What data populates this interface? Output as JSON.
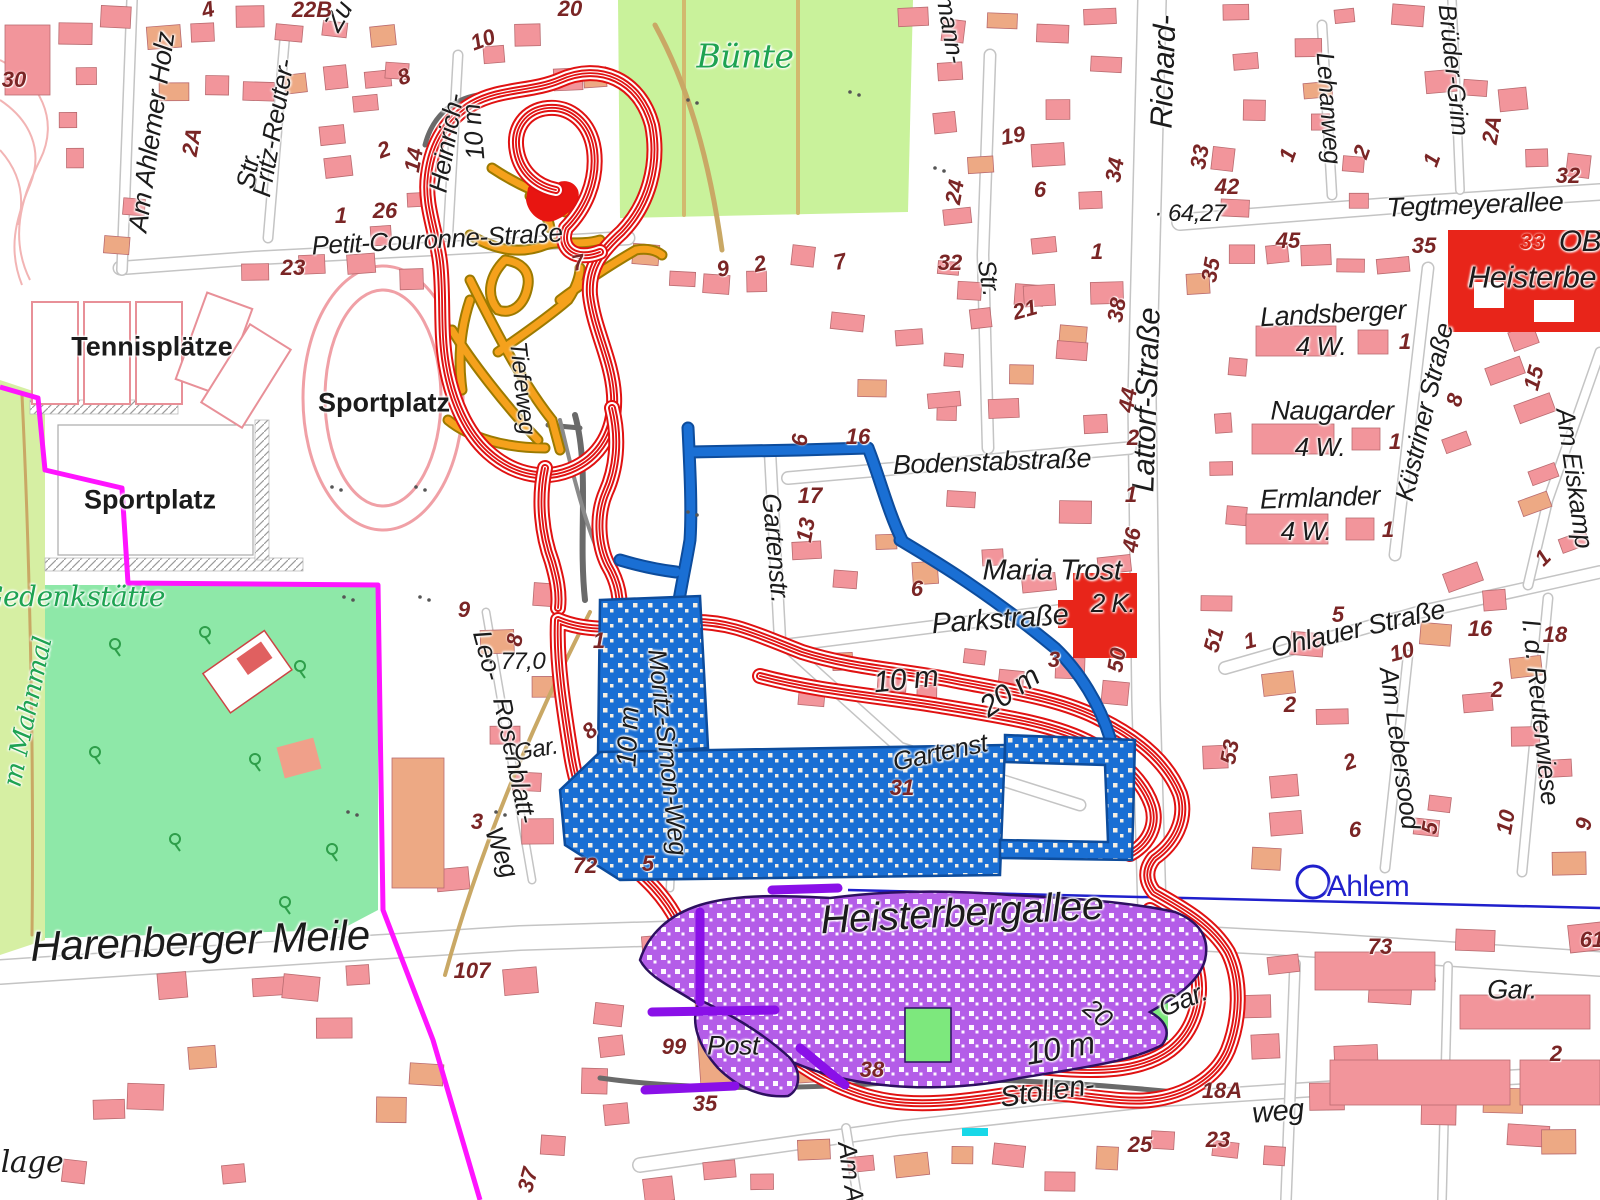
{
  "map": {
    "station": {
      "name": "Ahlem"
    },
    "colors": {
      "contour_red": "#e01212",
      "boundary_magenta": "#ff14ff",
      "network_blue": "#1a6fd4",
      "network_purple": "#b45de8",
      "network_dark_purple": "#8a10e8",
      "network_orange": "#f5a11c",
      "area_green_buente": "#c9f29b",
      "area_green_memorial": "#8ee8a8",
      "label_green": "#1ea352",
      "rail_blue": "#2020cc",
      "building_pink": "#f2959b",
      "building_red": "#e8251a"
    },
    "place_labels": [
      {
        "text": "Am Ahlemer Holz",
        "x": 152,
        "y": 132,
        "rot": -82,
        "size": 27
      },
      {
        "text": "Fritz-Reuter-",
        "x": 273,
        "y": 128,
        "rot": -80,
        "size": 26
      },
      {
        "text": "Str.",
        "x": 248,
        "y": 170,
        "rot": -80,
        "size": 26
      },
      {
        "text": "Zu",
        "x": 338,
        "y": 16,
        "rot": -60,
        "size": 26
      },
      {
        "text": "Heinrich-",
        "x": 446,
        "y": 143,
        "rot": -80,
        "size": 26
      },
      {
        "text": "Petit-Couronne-Straße",
        "x": 437,
        "y": 239,
        "rot": -3,
        "size": 26
      },
      {
        "text": "Bünte",
        "x": 745,
        "y": 56,
        "rot": 0,
        "size": 33,
        "color": "green",
        "style": "itsf"
      },
      {
        "text": "Tennisplätze",
        "x": 152,
        "y": 347,
        "rot": 0,
        "size": 27,
        "style": "up"
      },
      {
        "text": "Sportplatz",
        "x": 150,
        "y": 500,
        "rot": 0,
        "size": 27,
        "style": "up"
      },
      {
        "text": "Sportplatz",
        "x": 384,
        "y": 403,
        "rot": 0,
        "size": 27,
        "style": "up"
      },
      {
        "text": "Gedenkstätte",
        "x": 73,
        "y": 597,
        "rot": 0,
        "size": 28,
        "color": "green",
        "style": "itsf"
      },
      {
        "text": "m Mahnmal",
        "x": 28,
        "y": 712,
        "rot": -78,
        "size": 26,
        "color": "green",
        "style": "itsf"
      },
      {
        "text": "Harenberger Meile",
        "x": 200,
        "y": 941,
        "rot": -2,
        "size": 42
      },
      {
        "text": "Heisterbergallee",
        "x": 962,
        "y": 913,
        "rot": -3,
        "size": 40
      },
      {
        "text": "Richard-",
        "x": 1163,
        "y": 72,
        "rot": -88,
        "size": 31
      },
      {
        "text": "Lattorf-Straße",
        "x": 1146,
        "y": 400,
        "rot": -88,
        "size": 31
      },
      {
        "text": "Lehanweg",
        "x": 1328,
        "y": 108,
        "rot": 86,
        "size": 25
      },
      {
        "text": "Brüder-Grim",
        "x": 1453,
        "y": 70,
        "rot": 84,
        "size": 25
      },
      {
        "text": "Tegtmeyerallee",
        "x": 1475,
        "y": 205,
        "rot": -2,
        "size": 27
      },
      {
        "text": "Landsberger",
        "x": 1333,
        "y": 314,
        "rot": -3,
        "size": 27
      },
      {
        "text": "4 W.",
        "x": 1321,
        "y": 346,
        "rot": 0,
        "size": 26
      },
      {
        "text": "Naugarder",
        "x": 1332,
        "y": 411,
        "rot": 0,
        "size": 27
      },
      {
        "text": "4 W.",
        "x": 1320,
        "y": 447,
        "rot": 0,
        "size": 26
      },
      {
        "text": "Ermlander",
        "x": 1320,
        "y": 498,
        "rot": -2,
        "size": 27
      },
      {
        "text": "4 W.",
        "x": 1306,
        "y": 531,
        "rot": 0,
        "size": 26
      },
      {
        "text": "Küstriner Straße",
        "x": 1424,
        "y": 412,
        "rot": -77,
        "size": 26
      },
      {
        "text": "Am Eiskamp",
        "x": 1575,
        "y": 478,
        "rot": 82,
        "size": 26
      },
      {
        "text": "Heisterbe",
        "x": 1532,
        "y": 277,
        "rot": 0,
        "size": 31
      },
      {
        "text": "OB",
        "x": 1580,
        "y": 242,
        "rot": 0,
        "size": 30
      },
      {
        "text": "Bodenstabstraße",
        "x": 992,
        "y": 462,
        "rot": -2,
        "size": 27
      },
      {
        "text": "Gartenstr.",
        "x": 776,
        "y": 548,
        "rot": 85,
        "size": 26
      },
      {
        "text": "Gartenst",
        "x": 940,
        "y": 752,
        "rot": -12,
        "size": 26
      },
      {
        "text": "Maria Trost",
        "x": 1052,
        "y": 571,
        "rot": 0,
        "size": 29
      },
      {
        "text": "2 K.",
        "x": 1113,
        "y": 603,
        "rot": 0,
        "size": 26
      },
      {
        "text": "Parkstraße",
        "x": 1000,
        "y": 620,
        "rot": -4,
        "size": 29
      },
      {
        "text": "Ohlauer Straße",
        "x": 1358,
        "y": 629,
        "rot": -13,
        "size": 27
      },
      {
        "text": "Am Lebersood",
        "x": 1400,
        "y": 748,
        "rot": 82,
        "size": 26
      },
      {
        "text": "I. d. Reuterwiese",
        "x": 1541,
        "y": 712,
        "rot": 84,
        "size": 26
      },
      {
        "text": "Ahlem",
        "x": 1368,
        "y": 887,
        "rot": 0,
        "size": 30,
        "color": "blue",
        "style": "up2"
      },
      {
        "text": "Moritz-Simon-Weg",
        "x": 668,
        "y": 752,
        "rot": 84,
        "size": 26
      },
      {
        "text": "Leo-",
        "x": 488,
        "y": 655,
        "rot": 75,
        "size": 26
      },
      {
        "text": "Rosenblatt-",
        "x": 515,
        "y": 760,
        "rot": 78,
        "size": 26
      },
      {
        "text": "Weg",
        "x": 502,
        "y": 852,
        "rot": 70,
        "size": 26
      },
      {
        "text": "Tiefeweg",
        "x": 522,
        "y": 388,
        "rot": 84,
        "size": 24
      },
      {
        "text": "Gar.",
        "x": 536,
        "y": 750,
        "rot": -10,
        "size": 24
      },
      {
        "text": "Gar.",
        "x": 1183,
        "y": 1000,
        "rot": -22,
        "size": 27
      },
      {
        "text": "Gar.",
        "x": 1512,
        "y": 990,
        "rot": 0,
        "size": 27
      },
      {
        "text": "Stollen-",
        "x": 1047,
        "y": 1092,
        "rot": -8,
        "size": 29
      },
      {
        "text": "weg",
        "x": 1278,
        "y": 1112,
        "rot": -5,
        "size": 29
      },
      {
        "text": "Am As",
        "x": 852,
        "y": 1178,
        "rot": 82,
        "size": 26
      },
      {
        "text": "Post",
        "x": 733,
        "y": 1046,
        "rot": 0,
        "size": 27
      },
      {
        "text": "ulmann-",
        "x": 948,
        "y": 20,
        "rot": 80,
        "size": 25
      },
      {
        "text": "Str.",
        "x": 988,
        "y": 278,
        "rot": 80,
        "size": 25
      },
      {
        "text": "lage",
        "x": 32,
        "y": 1163,
        "rot": 0,
        "size": 30,
        "style": "itsf"
      }
    ],
    "contour_labels": [
      {
        "text": "10 m",
        "x": 906,
        "y": 680,
        "rot": -6,
        "size": 30
      },
      {
        "text": "20 m",
        "x": 1010,
        "y": 692,
        "rot": -35,
        "size": 30
      },
      {
        "text": "10 m",
        "x": 628,
        "y": 737,
        "rot": -87,
        "size": 28
      },
      {
        "text": "10 m",
        "x": 473,
        "y": 132,
        "rot": -95,
        "size": 26
      },
      {
        "text": "10 m",
        "x": 1060,
        "y": 1048,
        "rot": -10,
        "size": 32
      },
      {
        "text": "20",
        "x": 1098,
        "y": 1013,
        "rot": 40,
        "size": 26
      }
    ],
    "elevation_points": [
      {
        "text": "64,27",
        "x": 1190,
        "y": 214
      },
      {
        "text": "77,0",
        "x": 516,
        "y": 662
      }
    ],
    "house_numbers": [
      {
        "text": "30",
        "x": 14,
        "y": 80
      },
      {
        "text": "4",
        "x": 208,
        "y": 10,
        "rot": -15
      },
      {
        "text": "22B",
        "x": 312,
        "y": 10
      },
      {
        "text": "20",
        "x": 570,
        "y": 9
      },
      {
        "text": "2A",
        "x": 192,
        "y": 142,
        "rot": -80
      },
      {
        "text": "2",
        "x": 384,
        "y": 150,
        "rot": -20
      },
      {
        "text": "14",
        "x": 414,
        "y": 160,
        "rot": -80
      },
      {
        "text": "26",
        "x": 385,
        "y": 211
      },
      {
        "text": "1",
        "x": 341,
        "y": 216
      },
      {
        "text": "23",
        "x": 293,
        "y": 268
      },
      {
        "text": "8",
        "x": 404,
        "y": 77,
        "rot": -20
      },
      {
        "text": "10",
        "x": 483,
        "y": 40,
        "rot": -20
      },
      {
        "text": "7",
        "x": 578,
        "y": 263,
        "rot": -12
      },
      {
        "text": "9",
        "x": 723,
        "y": 269,
        "rot": -12
      },
      {
        "text": "2",
        "x": 760,
        "y": 264,
        "rot": -12
      },
      {
        "text": "7",
        "x": 840,
        "y": 262,
        "rot": -12
      },
      {
        "text": "19",
        "x": 1013,
        "y": 136,
        "rot": -10
      },
      {
        "text": "6",
        "x": 1040,
        "y": 190
      },
      {
        "text": "24",
        "x": 955,
        "y": 192,
        "rot": -80
      },
      {
        "text": "34",
        "x": 1115,
        "y": 170,
        "rot": -80
      },
      {
        "text": "32",
        "x": 950,
        "y": 263
      },
      {
        "text": "21",
        "x": 1025,
        "y": 310,
        "rot": -15
      },
      {
        "text": "1",
        "x": 1097,
        "y": 252
      },
      {
        "text": "38",
        "x": 1117,
        "y": 310,
        "rot": -80
      },
      {
        "text": "44",
        "x": 1128,
        "y": 400,
        "rot": -80
      },
      {
        "text": "2",
        "x": 1133,
        "y": 438
      },
      {
        "text": "1",
        "x": 1131,
        "y": 495
      },
      {
        "text": "46",
        "x": 1132,
        "y": 540,
        "rot": -80
      },
      {
        "text": "33",
        "x": 1200,
        "y": 157,
        "rot": -80
      },
      {
        "text": "42",
        "x": 1227,
        "y": 187
      },
      {
        "text": "1",
        "x": 1288,
        "y": 155,
        "rot": -70
      },
      {
        "text": "2",
        "x": 1362,
        "y": 152,
        "rot": -70
      },
      {
        "text": "1",
        "x": 1432,
        "y": 160,
        "rot": -70
      },
      {
        "text": "2A",
        "x": 1492,
        "y": 130,
        "rot": -80
      },
      {
        "text": "32",
        "x": 1568,
        "y": 176
      },
      {
        "text": "45",
        "x": 1288,
        "y": 241
      },
      {
        "text": "35",
        "x": 1424,
        "y": 246
      },
      {
        "text": "35",
        "x": 1211,
        "y": 270,
        "rot": -80
      },
      {
        "text": "33",
        "x": 1532,
        "y": 242,
        "color": "#e02010"
      },
      {
        "text": "3",
        "x": 1054,
        "y": 660
      },
      {
        "text": "50",
        "x": 1117,
        "y": 660,
        "rot": -80
      },
      {
        "text": "6",
        "x": 800,
        "y": 440,
        "rot": -85
      },
      {
        "text": "16",
        "x": 858,
        "y": 437
      },
      {
        "text": "17",
        "x": 810,
        "y": 496
      },
      {
        "text": "13",
        "x": 806,
        "y": 530,
        "rot": -80
      },
      {
        "text": "6",
        "x": 917,
        "y": 589
      },
      {
        "text": "9",
        "x": 464,
        "y": 610
      },
      {
        "text": "8",
        "x": 515,
        "y": 640,
        "rot": -80
      },
      {
        "text": "1",
        "x": 599,
        "y": 641
      },
      {
        "text": "8",
        "x": 590,
        "y": 731,
        "rot": -40
      },
      {
        "text": "72",
        "x": 585,
        "y": 866
      },
      {
        "text": "5",
        "x": 648,
        "y": 864
      },
      {
        "text": "31",
        "x": 902,
        "y": 788
      },
      {
        "text": "3",
        "x": 477,
        "y": 822
      },
      {
        "text": "51",
        "x": 1214,
        "y": 640,
        "rot": -75
      },
      {
        "text": "1",
        "x": 1250,
        "y": 641,
        "rot": -15
      },
      {
        "text": "5",
        "x": 1338,
        "y": 615
      },
      {
        "text": "2",
        "x": 1290,
        "y": 705
      },
      {
        "text": "53",
        "x": 1230,
        "y": 752,
        "rot": -80
      },
      {
        "text": "2",
        "x": 1350,
        "y": 762,
        "rot": -20
      },
      {
        "text": "6",
        "x": 1355,
        "y": 830
      },
      {
        "text": "10",
        "x": 1402,
        "y": 652,
        "rot": -15
      },
      {
        "text": "5",
        "x": 1430,
        "y": 828,
        "rot": -80
      },
      {
        "text": "16",
        "x": 1480,
        "y": 629
      },
      {
        "text": "2",
        "x": 1497,
        "y": 690
      },
      {
        "text": "18",
        "x": 1555,
        "y": 635
      },
      {
        "text": "10",
        "x": 1506,
        "y": 822,
        "rot": -80
      },
      {
        "text": "9",
        "x": 1584,
        "y": 824,
        "rot": -80
      },
      {
        "text": "1",
        "x": 1543,
        "y": 558,
        "rot": -45
      },
      {
        "text": "8",
        "x": 1455,
        "y": 400,
        "rot": -75
      },
      {
        "text": "15",
        "x": 1534,
        "y": 378,
        "rot": -75
      },
      {
        "text": "1",
        "x": 1405,
        "y": 342
      },
      {
        "text": "1",
        "x": 1395,
        "y": 442
      },
      {
        "text": "1",
        "x": 1388,
        "y": 530
      },
      {
        "text": "107",
        "x": 472,
        "y": 971
      },
      {
        "text": "99",
        "x": 674,
        "y": 1047
      },
      {
        "text": "38",
        "x": 872,
        "y": 1070
      },
      {
        "text": "35",
        "x": 705,
        "y": 1104
      },
      {
        "text": "37",
        "x": 528,
        "y": 1180,
        "rot": -75
      },
      {
        "text": "25",
        "x": 1140,
        "y": 1145
      },
      {
        "text": "18A",
        "x": 1222,
        "y": 1091
      },
      {
        "text": "23",
        "x": 1218,
        "y": 1140
      },
      {
        "text": "2",
        "x": 1556,
        "y": 1054
      },
      {
        "text": "73",
        "x": 1380,
        "y": 947
      },
      {
        "text": "61",
        "x": 1592,
        "y": 940
      }
    ]
  }
}
